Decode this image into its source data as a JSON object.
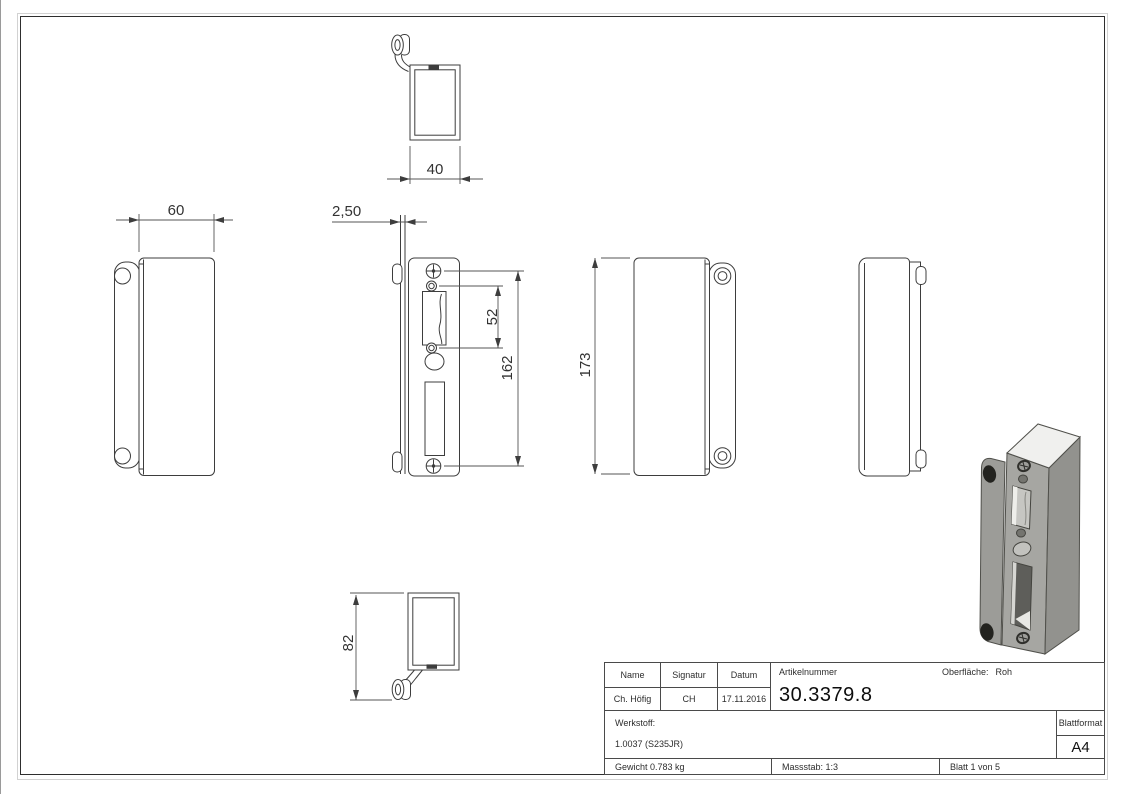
{
  "drawing": {
    "dimensions": {
      "top_width": "40",
      "front_width": "60",
      "plate_thickness": "2,50",
      "hole_spacing": "52",
      "screw_spacing": "162",
      "total_height": "173",
      "side_depth": "82"
    },
    "iso_colors": {
      "top": "#f0f0ee",
      "front": "#a6a6a2",
      "side": "#92928e",
      "flange": "#9c9c98",
      "hole": "#23231f",
      "slot_interior": "#c6c6c2",
      "slot_dark": "#5e5e5a",
      "oval": "#c2c2be"
    },
    "title_block": {
      "name_label": "Name",
      "signature_label": "Signatur",
      "date_label": "Datum",
      "article_label": "Artikelnummer",
      "surface_label": "Oberfläche:",
      "surface_value": "Roh",
      "name_value": "Ch. Höfig",
      "signature_value": "CH",
      "date_value": "17.11.2016",
      "article_number": "30.3379.8",
      "material_label": "Werkstoff:",
      "material_value": "1.0037 (S235JR)",
      "weight": "Gewicht 0.783 kg",
      "scale": "Massstab: 1:3",
      "sheet": "Blatt 1 von 5",
      "sheet_format_label": "Blattformat",
      "sheet_format_value": "A4"
    }
  }
}
